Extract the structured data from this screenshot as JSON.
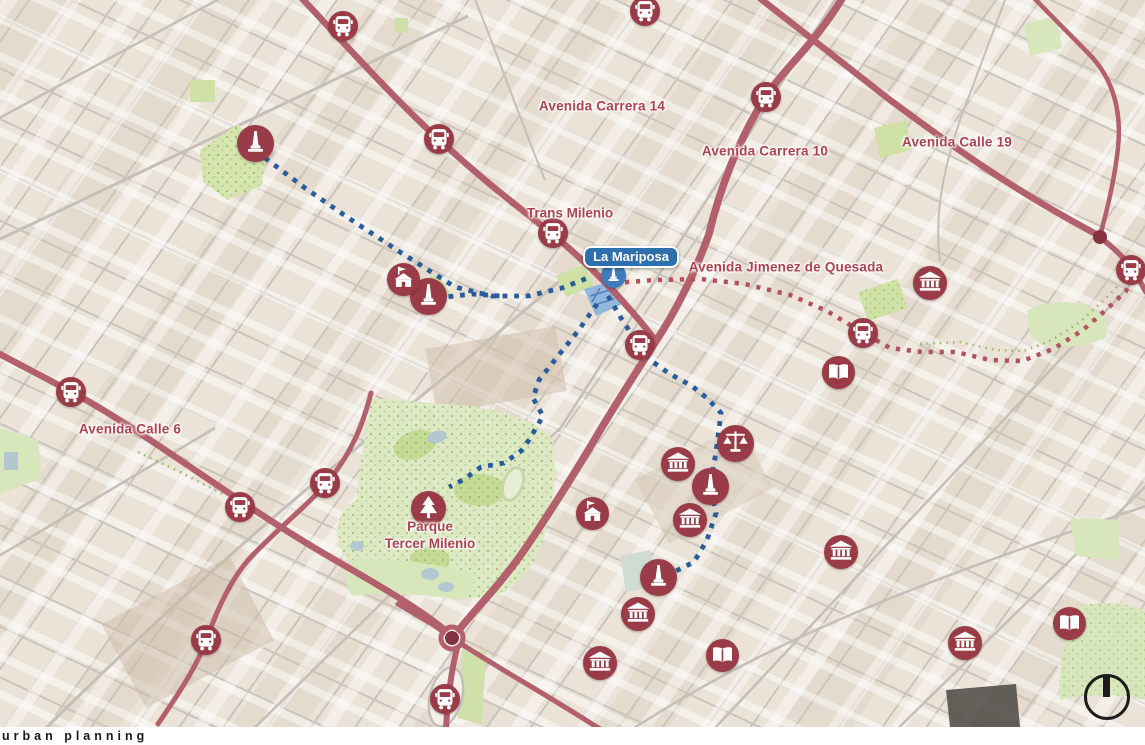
{
  "map": {
    "street_labels": [
      {
        "id": "avenida-carrera-14",
        "text": "Avenida Carrera 14",
        "x": 602,
        "y": 106
      },
      {
        "id": "avenida-carrera-10",
        "text": "Avenida Carrera 10",
        "x": 765,
        "y": 151
      },
      {
        "id": "avenida-calle-19",
        "text": "Avenida Calle 19",
        "x": 957,
        "y": 142
      },
      {
        "id": "avenida-jimenez-de-quesada",
        "text": "Avenida Jimenez de Quesada",
        "x": 786,
        "y": 267
      },
      {
        "id": "avenida-calle-6",
        "text": "Avenida Calle 6",
        "x": 130,
        "y": 429
      }
    ],
    "place_labels": [
      {
        "id": "trans-milenio",
        "text": "Trans Milenio",
        "x": 570,
        "y": 214
      },
      {
        "id": "parque-tercer-milenio",
        "text": "Parque\nTercer Milenio",
        "x": 430,
        "y": 536
      }
    ],
    "badge": {
      "id": "la-mariposa",
      "text": "La Mariposa",
      "x": 631,
      "y": 257,
      "color": "#2e6fad"
    },
    "pois": [
      {
        "type": "bus",
        "x": 343,
        "y": 26
      },
      {
        "type": "bus",
        "x": 645,
        "y": 11
      },
      {
        "type": "bus",
        "x": 766,
        "y": 97
      },
      {
        "type": "bus",
        "x": 439,
        "y": 139
      },
      {
        "type": "bus",
        "x": 553,
        "y": 233
      },
      {
        "type": "bus",
        "x": 640,
        "y": 345
      },
      {
        "type": "bus",
        "x": 863,
        "y": 333
      },
      {
        "type": "bus",
        "x": 1131,
        "y": 270
      },
      {
        "type": "bus",
        "x": 71,
        "y": 392
      },
      {
        "type": "bus",
        "x": 325,
        "y": 483
      },
      {
        "type": "bus",
        "x": 240,
        "y": 507
      },
      {
        "type": "bus",
        "x": 206,
        "y": 640
      },
      {
        "type": "bus",
        "x": 445,
        "y": 699
      },
      {
        "type": "museum",
        "x": 930,
        "y": 283
      },
      {
        "type": "museum",
        "x": 678,
        "y": 464
      },
      {
        "type": "museum",
        "x": 690,
        "y": 520
      },
      {
        "type": "museum",
        "x": 638,
        "y": 614
      },
      {
        "type": "museum",
        "x": 600,
        "y": 663
      },
      {
        "type": "museum",
        "x": 841,
        "y": 552
      },
      {
        "type": "museum",
        "x": 965,
        "y": 643
      },
      {
        "type": "book",
        "x": 838,
        "y": 372
      },
      {
        "type": "book",
        "x": 722,
        "y": 655
      },
      {
        "type": "book",
        "x": 1069,
        "y": 623
      },
      {
        "type": "monument",
        "x": 255,
        "y": 143
      },
      {
        "type": "monument",
        "x": 428,
        "y": 296
      },
      {
        "type": "monument",
        "x": 710,
        "y": 486
      },
      {
        "type": "monument",
        "x": 658,
        "y": 577
      },
      {
        "type": "monument-blue",
        "x": 613,
        "y": 275
      },
      {
        "type": "church",
        "x": 403,
        "y": 279
      },
      {
        "type": "church",
        "x": 592,
        "y": 513
      },
      {
        "type": "justice",
        "x": 735,
        "y": 443
      },
      {
        "type": "tree",
        "x": 428,
        "y": 508
      }
    ],
    "routes": [
      {
        "id": "walking-route-northwest",
        "color": "#2a5c9c",
        "width": 4.8,
        "dash": "4.8 6.8",
        "points": [
          [
            265,
            158
          ],
          [
            305,
            188
          ],
          [
            350,
            219
          ],
          [
            400,
            252
          ],
          [
            455,
            287
          ],
          [
            492,
            296
          ],
          [
            528,
            296
          ],
          [
            562,
            288
          ],
          [
            590,
            277
          ]
        ]
      },
      {
        "id": "walking-route-monument-spur",
        "color": "#2a5c9c",
        "width": 4.8,
        "dash": "4.8 6.8",
        "points": [
          [
            437,
            298
          ],
          [
            472,
            294
          ],
          [
            500,
            296
          ]
        ]
      },
      {
        "id": "walking-route-southeast",
        "color": "#2a5c9c",
        "width": 4.8,
        "dash": "4.8 6.8",
        "points": [
          [
            608,
            296
          ],
          [
            621,
            318
          ],
          [
            634,
            338
          ],
          [
            650,
            360
          ],
          [
            670,
            374
          ],
          [
            692,
            386
          ],
          [
            708,
            399
          ],
          [
            721,
            413
          ],
          [
            716,
            452
          ],
          [
            710,
            487
          ],
          [
            716,
            513
          ],
          [
            707,
            540
          ],
          [
            694,
            562
          ],
          [
            676,
            571
          ],
          [
            659,
            578
          ]
        ]
      },
      {
        "id": "walking-route-park",
        "color": "#2a5c9c",
        "width": 4.8,
        "dash": "4.8 6.8",
        "points": [
          [
            597,
            304
          ],
          [
            578,
            331
          ],
          [
            558,
            356
          ],
          [
            539,
            380
          ],
          [
            533,
            398
          ],
          [
            543,
            416
          ],
          [
            529,
            440
          ],
          [
            521,
            451
          ],
          [
            504,
            463
          ],
          [
            481,
            467
          ],
          [
            463,
            480
          ],
          [
            449,
            487
          ]
        ]
      },
      {
        "id": "transit-route-jimenez",
        "color": "#b25261",
        "width": 4.5,
        "dash": "4.2 6.8",
        "points": [
          [
            614,
            283
          ],
          [
            655,
            280
          ],
          [
            700,
            279
          ],
          [
            745,
            284
          ],
          [
            790,
            295
          ],
          [
            827,
            311
          ],
          [
            860,
            331
          ],
          [
            890,
            348
          ],
          [
            922,
            352
          ],
          [
            956,
            352
          ],
          [
            990,
            360
          ],
          [
            1022,
            361
          ],
          [
            1053,
            349
          ],
          [
            1083,
            330
          ],
          [
            1108,
            308
          ],
          [
            1126,
            291
          ],
          [
            1134,
            273
          ]
        ]
      },
      {
        "id": "tree-row-jimenez",
        "color": "#9db86e",
        "width": 2.5,
        "dash": "1.6 5",
        "points": [
          [
            920,
            344
          ],
          [
            960,
            342
          ],
          [
            995,
            350
          ],
          [
            1024,
            351
          ],
          [
            1052,
            340
          ],
          [
            1080,
            322
          ],
          [
            1104,
            300
          ],
          [
            1120,
            284
          ]
        ]
      },
      {
        "id": "tree-row-calle6",
        "color": "#9db86e",
        "width": 2.5,
        "dash": "1.6 5",
        "points": [
          [
            138,
            452
          ],
          [
            180,
            472
          ],
          [
            225,
            495
          ]
        ]
      }
    ],
    "junctions": [
      [
        1100,
        237
      ],
      [
        452,
        638
      ]
    ],
    "colors": {
      "road_red": "#b2606b",
      "icon_red": "#9a3c47",
      "icon_blue": "#3f7cbb",
      "route_blue": "#2a5c9c",
      "route_red": "#b25261",
      "label_red": "#b04250",
      "park_green": "#dce9c3"
    }
  },
  "footer": {
    "text": "urban planning"
  }
}
